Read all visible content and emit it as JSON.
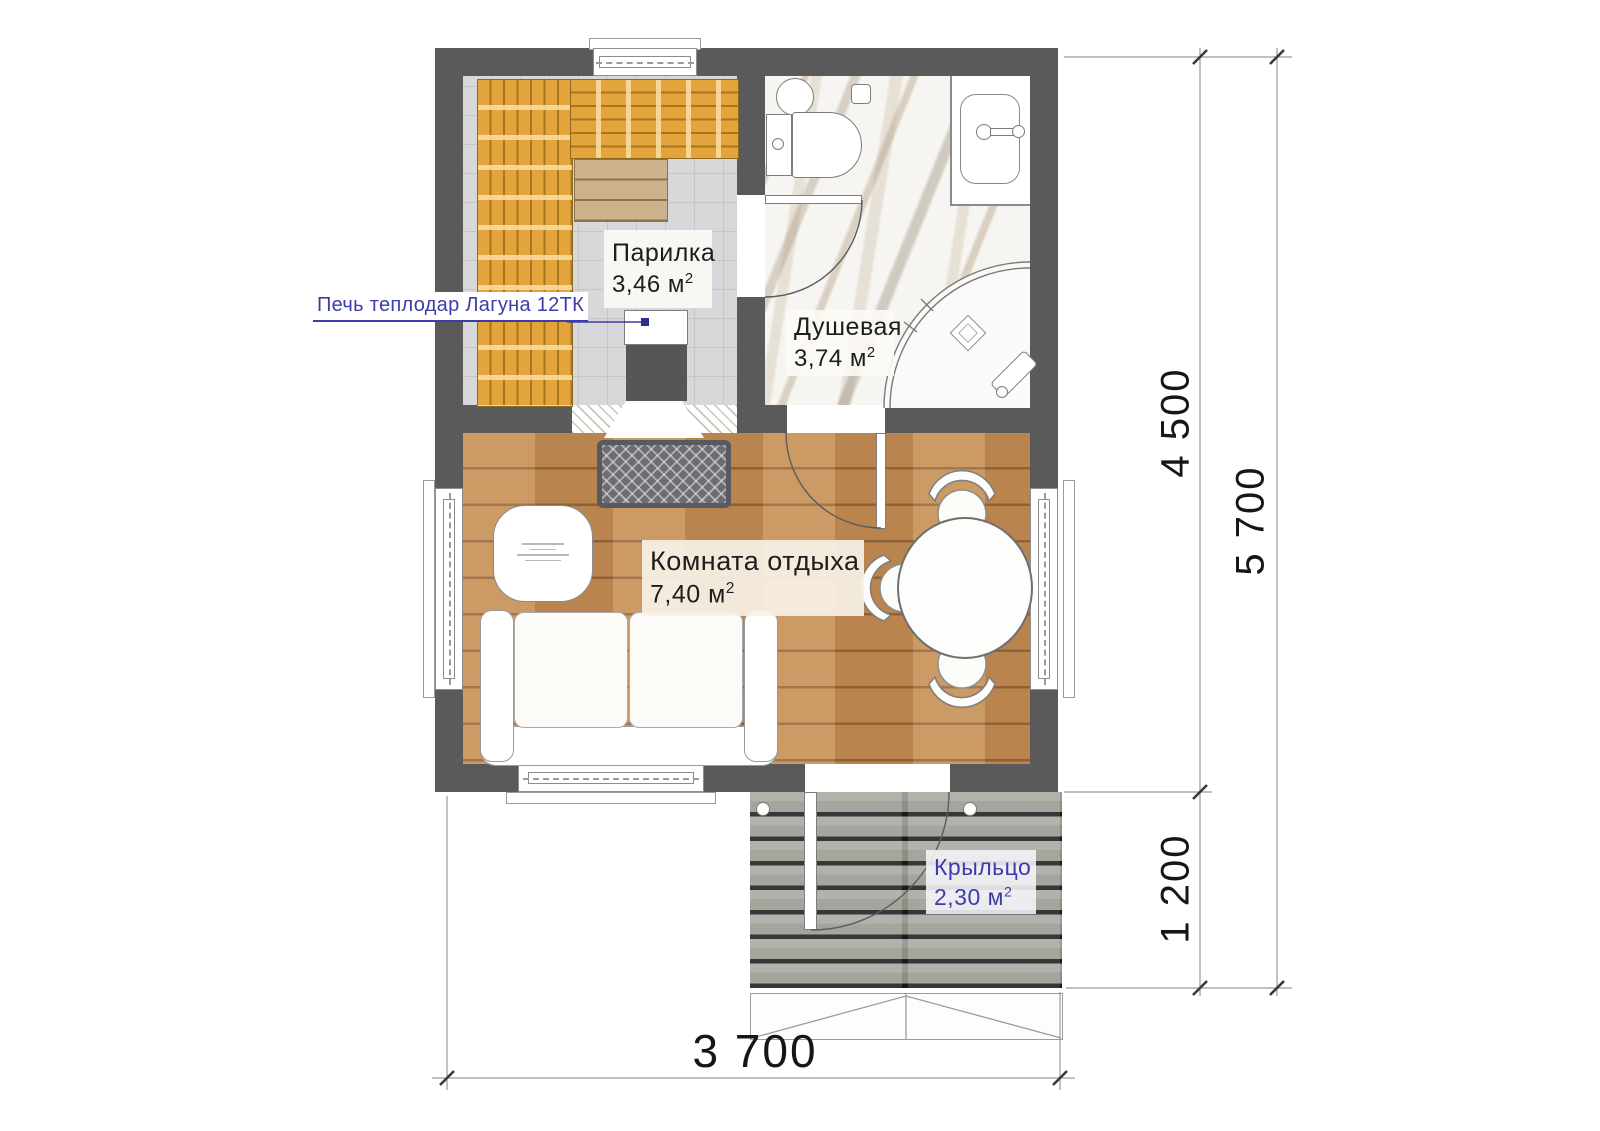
{
  "document": {
    "type": "bath-house floor plan"
  },
  "rooms": [
    {
      "id": "parilka",
      "label": "Парилка",
      "area": "3,46 м",
      "sup": "2"
    },
    {
      "id": "dushevaya",
      "label": "Душевая",
      "area": "3,74 м",
      "sup": "2"
    },
    {
      "id": "komnata-otdyha",
      "label": "Комната отдыха",
      "area": "7,40 м",
      "sup": "2"
    },
    {
      "id": "kryltso",
      "label": "Крыльцо",
      "area": "2,30 м",
      "sup": "2"
    }
  ],
  "annotations": {
    "stove_label": "Печь теплодар Лагуна 12ТК"
  },
  "dimensions": {
    "height_main": "4 500",
    "height_porch": "1 200",
    "height_total": "5 700",
    "width_total": "3 700"
  },
  "colors": {
    "wall": "#5a5a5a",
    "sauna_bench": "#e3a43c",
    "wood_floor": "#c58d54",
    "porch_plank": "#a8a7a2",
    "label_blue": "#3c3caa",
    "dim_text": "#161616"
  }
}
